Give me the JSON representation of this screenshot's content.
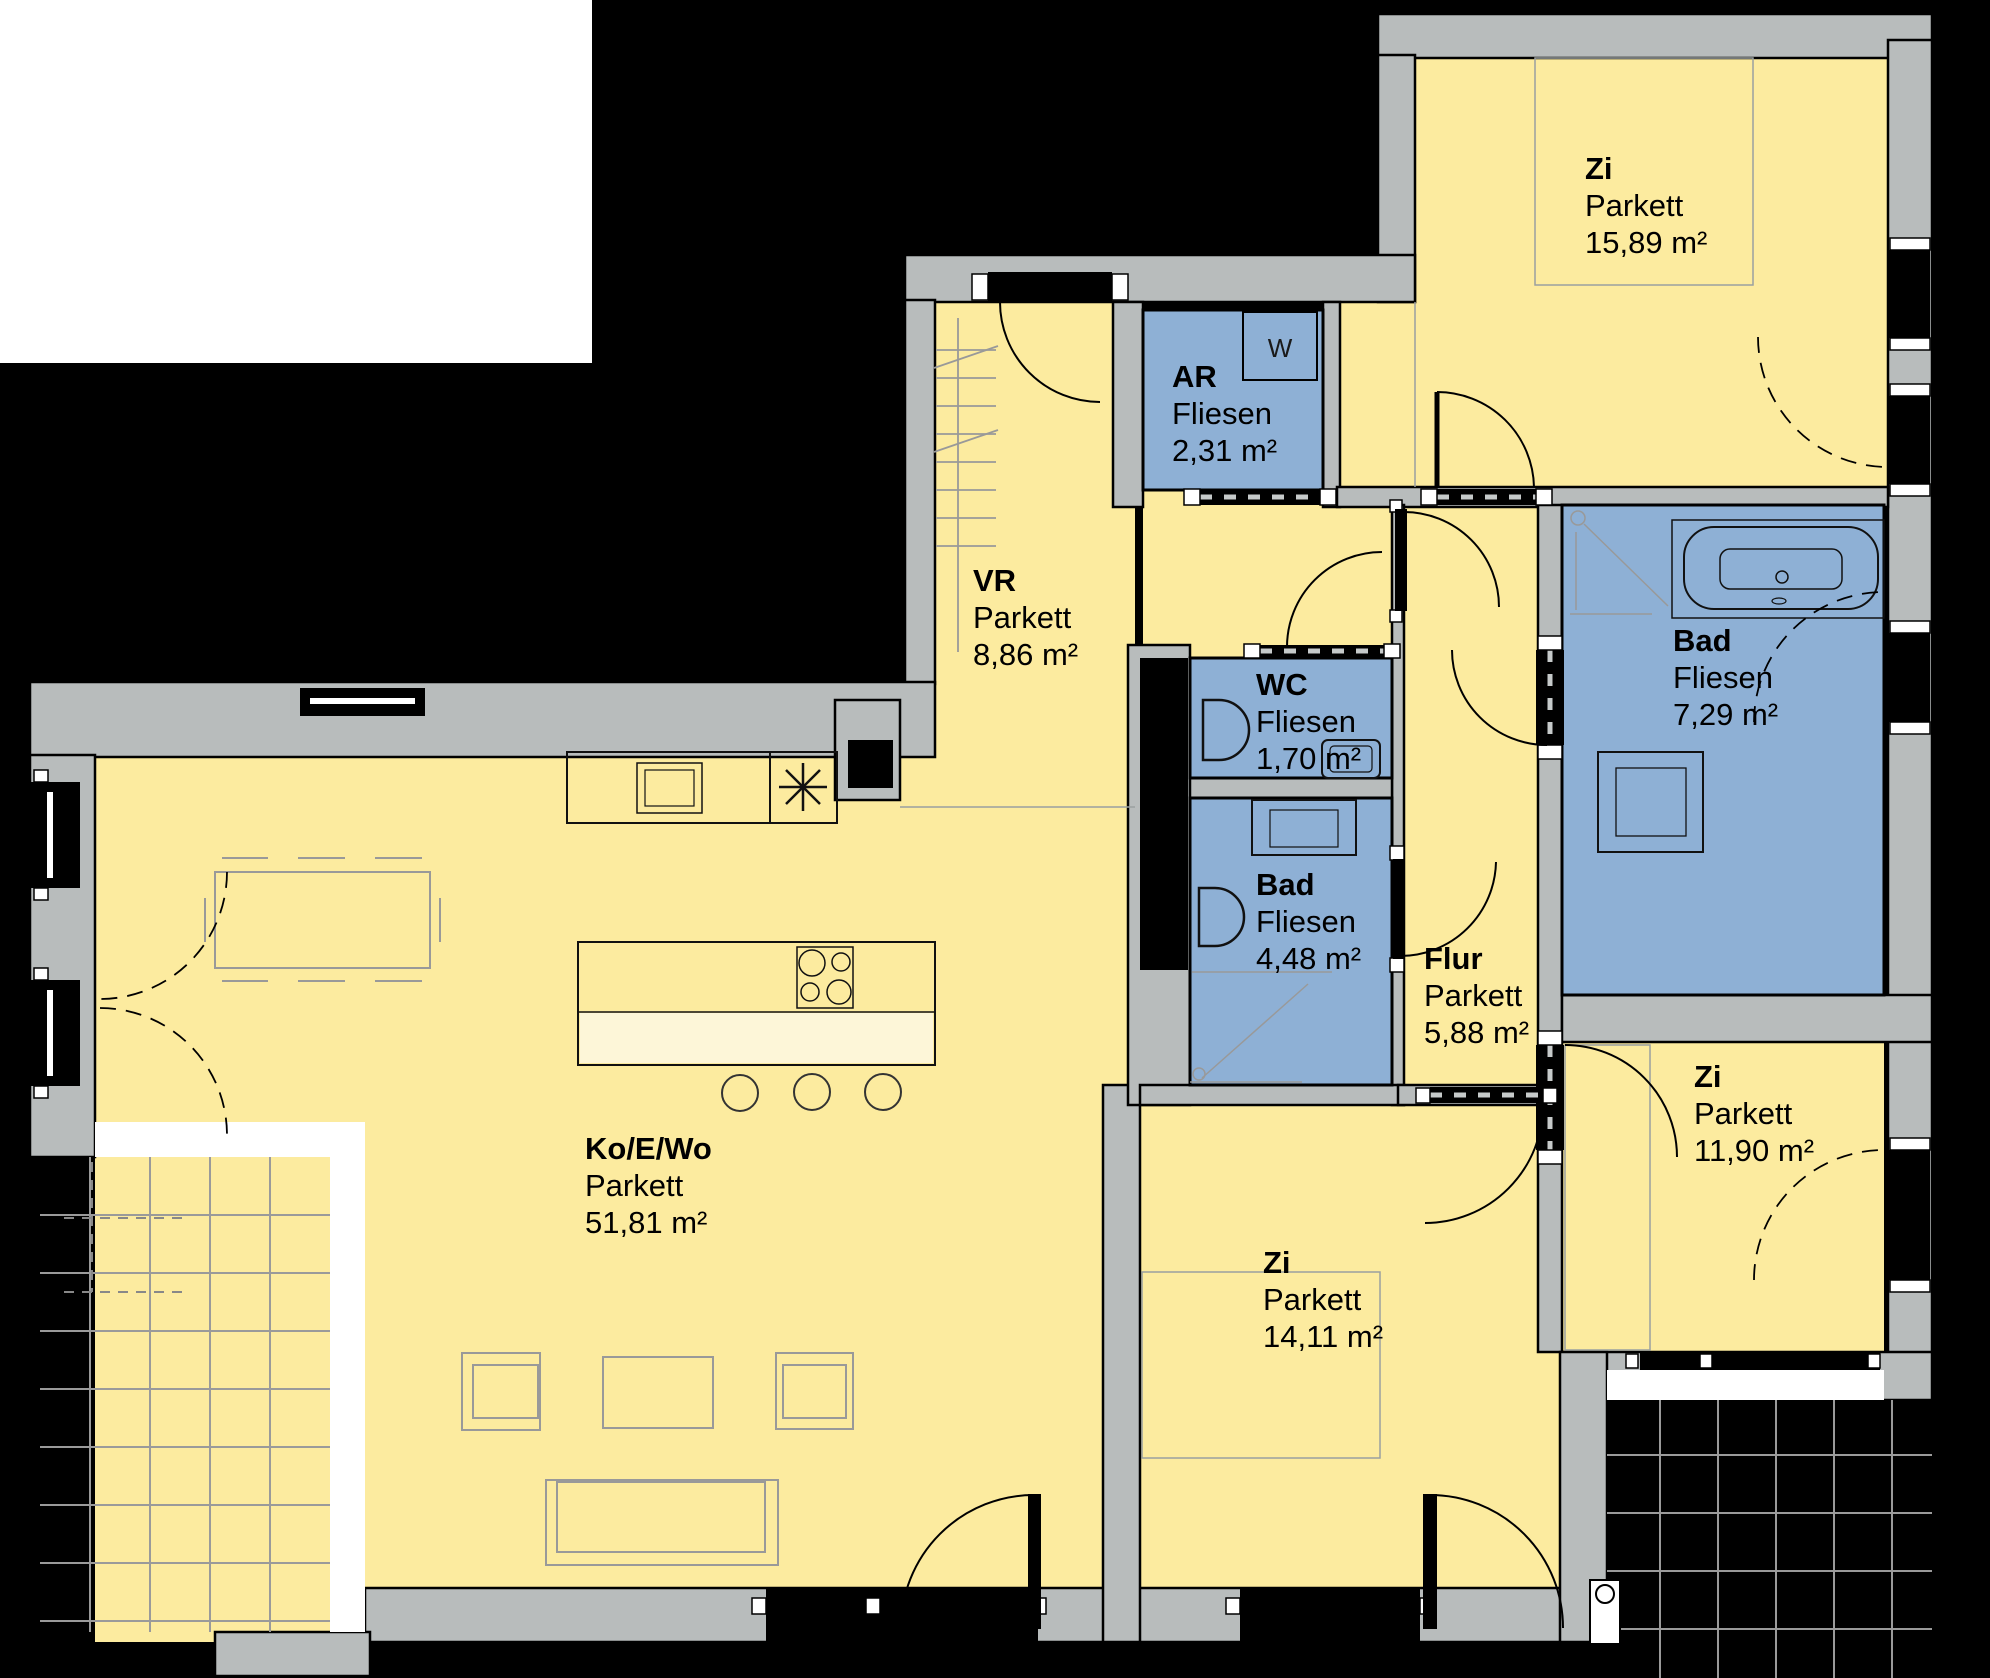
{
  "rooms": [
    {
      "key": "zi-top",
      "name": "Zi",
      "floor": "Parkett",
      "area": "15,89 m²"
    },
    {
      "key": "ar",
      "name": "AR",
      "floor": "Fliesen",
      "area": "2,31 m²"
    },
    {
      "key": "vr",
      "name": "VR",
      "floor": "Parkett",
      "area": "8,86 m²"
    },
    {
      "key": "wc",
      "name": "WC",
      "floor": "Fliesen",
      "area": "1,70 m²"
    },
    {
      "key": "bad-klein",
      "name": "Bad",
      "floor": "Fliesen",
      "area": "4,48 m²"
    },
    {
      "key": "bad-gross",
      "name": "Bad",
      "floor": "Fliesen",
      "area": "7,29 m²"
    },
    {
      "key": "flur",
      "name": "Flur",
      "floor": "Parkett",
      "area": "5,88 m²"
    },
    {
      "key": "zi-rechts",
      "name": "Zi",
      "floor": "Parkett",
      "area": "11,90 m²"
    },
    {
      "key": "kowo",
      "name": "Ko/E/Wo",
      "floor": "Parkett",
      "area": "51,81 m²"
    },
    {
      "key": "zi-mitte",
      "name": "Zi",
      "floor": "Parkett",
      "area": "14,11 m²"
    }
  ],
  "appliances": {
    "washer_label": "W"
  },
  "colors": {
    "parquet_floor": "#fceb9f",
    "tile_floor": "#8eb0d5",
    "walls": "#b8bcbc",
    "background": "#000000",
    "outside": "#ffffff",
    "island_counter": "#fdf6d8"
  }
}
